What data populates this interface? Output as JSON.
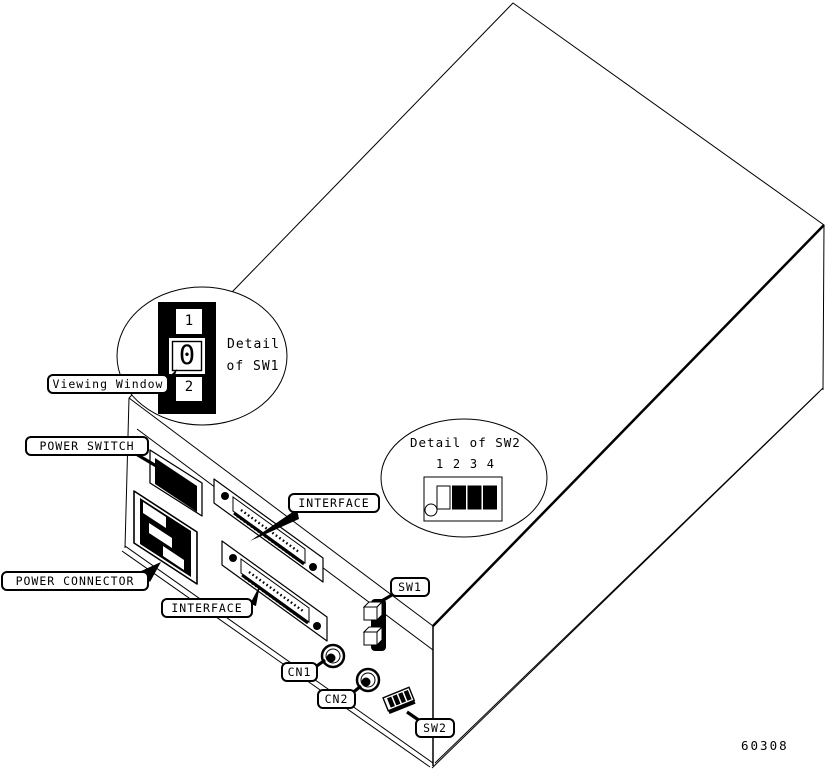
{
  "figure_number": "60308",
  "callouts": {
    "viewing_window": "Viewing Window",
    "power_switch": "POWER SWITCH",
    "power_connector": "POWER CONNECTOR",
    "interface_upper": "INTERFACE",
    "interface_lower": "INTERFACE",
    "sw1": "SW1",
    "cn1": "CN1",
    "cn2": "CN2",
    "sw2": "SW2"
  },
  "sw1_detail": {
    "title_line1": "Detail",
    "title_line2": "of SW1",
    "position_top": "1",
    "position_window": "0",
    "position_bottom": "2"
  },
  "sw2_detail": {
    "title": "Detail of SW2",
    "positions": [
      "1",
      "2",
      "3",
      "4"
    ],
    "state_colors": [
      "#ffffff",
      "#000000",
      "#000000",
      "#000000"
    ]
  },
  "colors": {
    "ink": "#000000",
    "paper": "#ffffff"
  }
}
